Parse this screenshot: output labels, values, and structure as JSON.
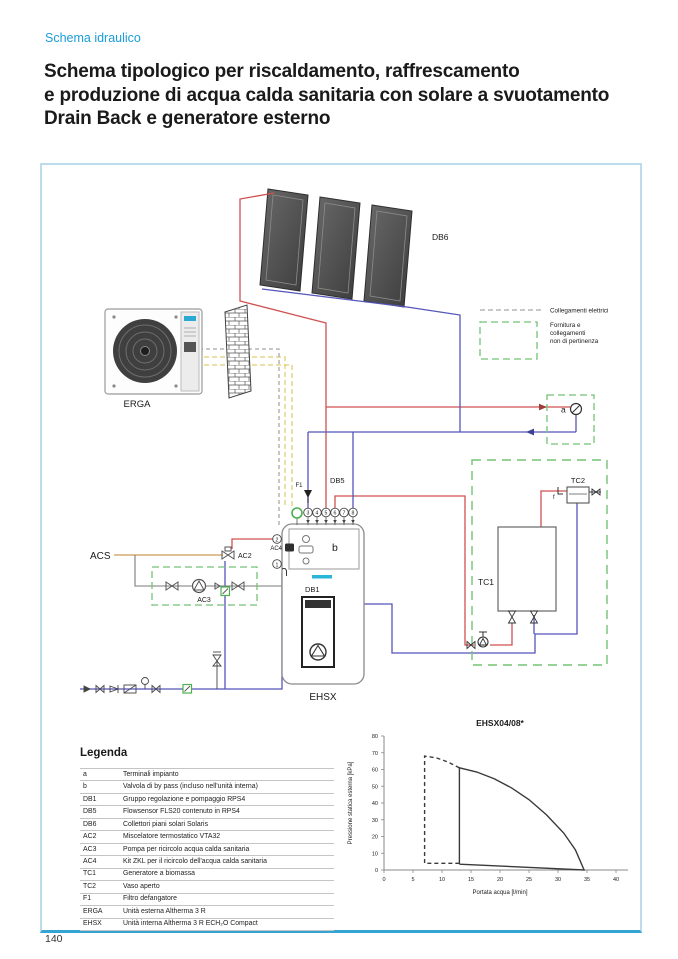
{
  "page": {
    "eyebrow": "Schema idraulico",
    "title": "Schema tipologico per riscaldamento, raffrescamento\ne produzione di acqua calda sanitaria con solare a svuotamento\nDrain Back e generatore esterno",
    "page_number": "140"
  },
  "diagram": {
    "labels": {
      "db6": "DB6",
      "erga": "ERGA",
      "db5": "DB5",
      "db1": "DB1",
      "ehsx": "EHSX",
      "tc1": "TC1",
      "tc2": "TC2",
      "acs": "ACS",
      "ac2": "AC2",
      "ac3": "AC3",
      "ac4": "AC4",
      "f1": "F1",
      "a": "a",
      "b": "b",
      "f": "f"
    },
    "ports_top": [
      "3",
      "4",
      "5",
      "6",
      "7",
      "8"
    ],
    "ports_left": [
      "2",
      "1"
    ],
    "legend": {
      "electrical": "Collegamenti elettrici",
      "supply_lines": [
        "Fornitura e",
        "collegamenti",
        "non di pertinenza"
      ]
    },
    "colors": {
      "pipe_hot": "#d05050",
      "pipe_cold": "#5555bb",
      "pipe_dhw": "#cc9a55",
      "refrigerant": "#e2cc74",
      "electrical": "#a8a8a8",
      "out_of_scope": "#74c274",
      "accent_blue": "#1b9cd8",
      "logo_teal": "#29b6d8"
    }
  },
  "legend_table": {
    "heading": "Legenda",
    "rows": [
      [
        "a",
        "Terminali impianto"
      ],
      [
        "b",
        "Valvola di by pass (incluso nell'unità interna)"
      ],
      [
        "DB1",
        "Gruppo regolazione e pompaggio RPS4"
      ],
      [
        "DB5",
        "Flowsensor FLS20 contenuto in RPS4"
      ],
      [
        "DB6",
        "Collettori piani solari Solaris"
      ],
      [
        "AC2",
        "Miscelatore termostatico VTA32"
      ],
      [
        "AC3",
        "Pompa per ricircolo acqua calda sanitaria"
      ],
      [
        "AC4",
        "Kit ZKL per il ricircolo dell'acqua calda sanitaria"
      ],
      [
        "TC1",
        "Generatore a biomassa"
      ],
      [
        "TC2",
        "Vaso aperto"
      ],
      [
        "F1",
        "Filtro defangatore"
      ],
      [
        "ERGA",
        "Unità esterna Altherma 3 R"
      ],
      [
        "EHSX",
        "Unità interna  Altherma 3 R ECH₂O Compact"
      ]
    ]
  },
  "chart_data": {
    "type": "line",
    "title": "EHSX04/08*",
    "xlabel": "Portata acqua [l/min]",
    "ylabel": "Pressione statica esterna [kPa]",
    "xlim": [
      0,
      40
    ],
    "ylim": [
      0,
      80
    ],
    "xticks": [
      0,
      5,
      10,
      15,
      20,
      25,
      30,
      35,
      40
    ],
    "yticks": [
      0,
      10,
      20,
      30,
      40,
      50,
      60,
      70,
      80
    ],
    "grid": false,
    "legend_position": "none",
    "series": [
      {
        "name": "operating-envelope",
        "style": "solid",
        "points": [
          [
            13,
            3.5
          ],
          [
            13,
            61
          ],
          [
            16,
            58.5
          ],
          [
            19,
            54.5
          ],
          [
            22,
            49
          ],
          [
            25,
            42
          ],
          [
            28,
            33
          ],
          [
            31,
            22
          ],
          [
            33,
            12
          ],
          [
            34.5,
            0
          ],
          [
            13,
            3.5
          ]
        ]
      },
      {
        "name": "extended-envelope",
        "style": "dashed",
        "points": [
          [
            13,
            61
          ],
          [
            11,
            64.5
          ],
          [
            9,
            67
          ],
          [
            7,
            68
          ],
          [
            7,
            4
          ],
          [
            13,
            4
          ]
        ]
      }
    ]
  }
}
